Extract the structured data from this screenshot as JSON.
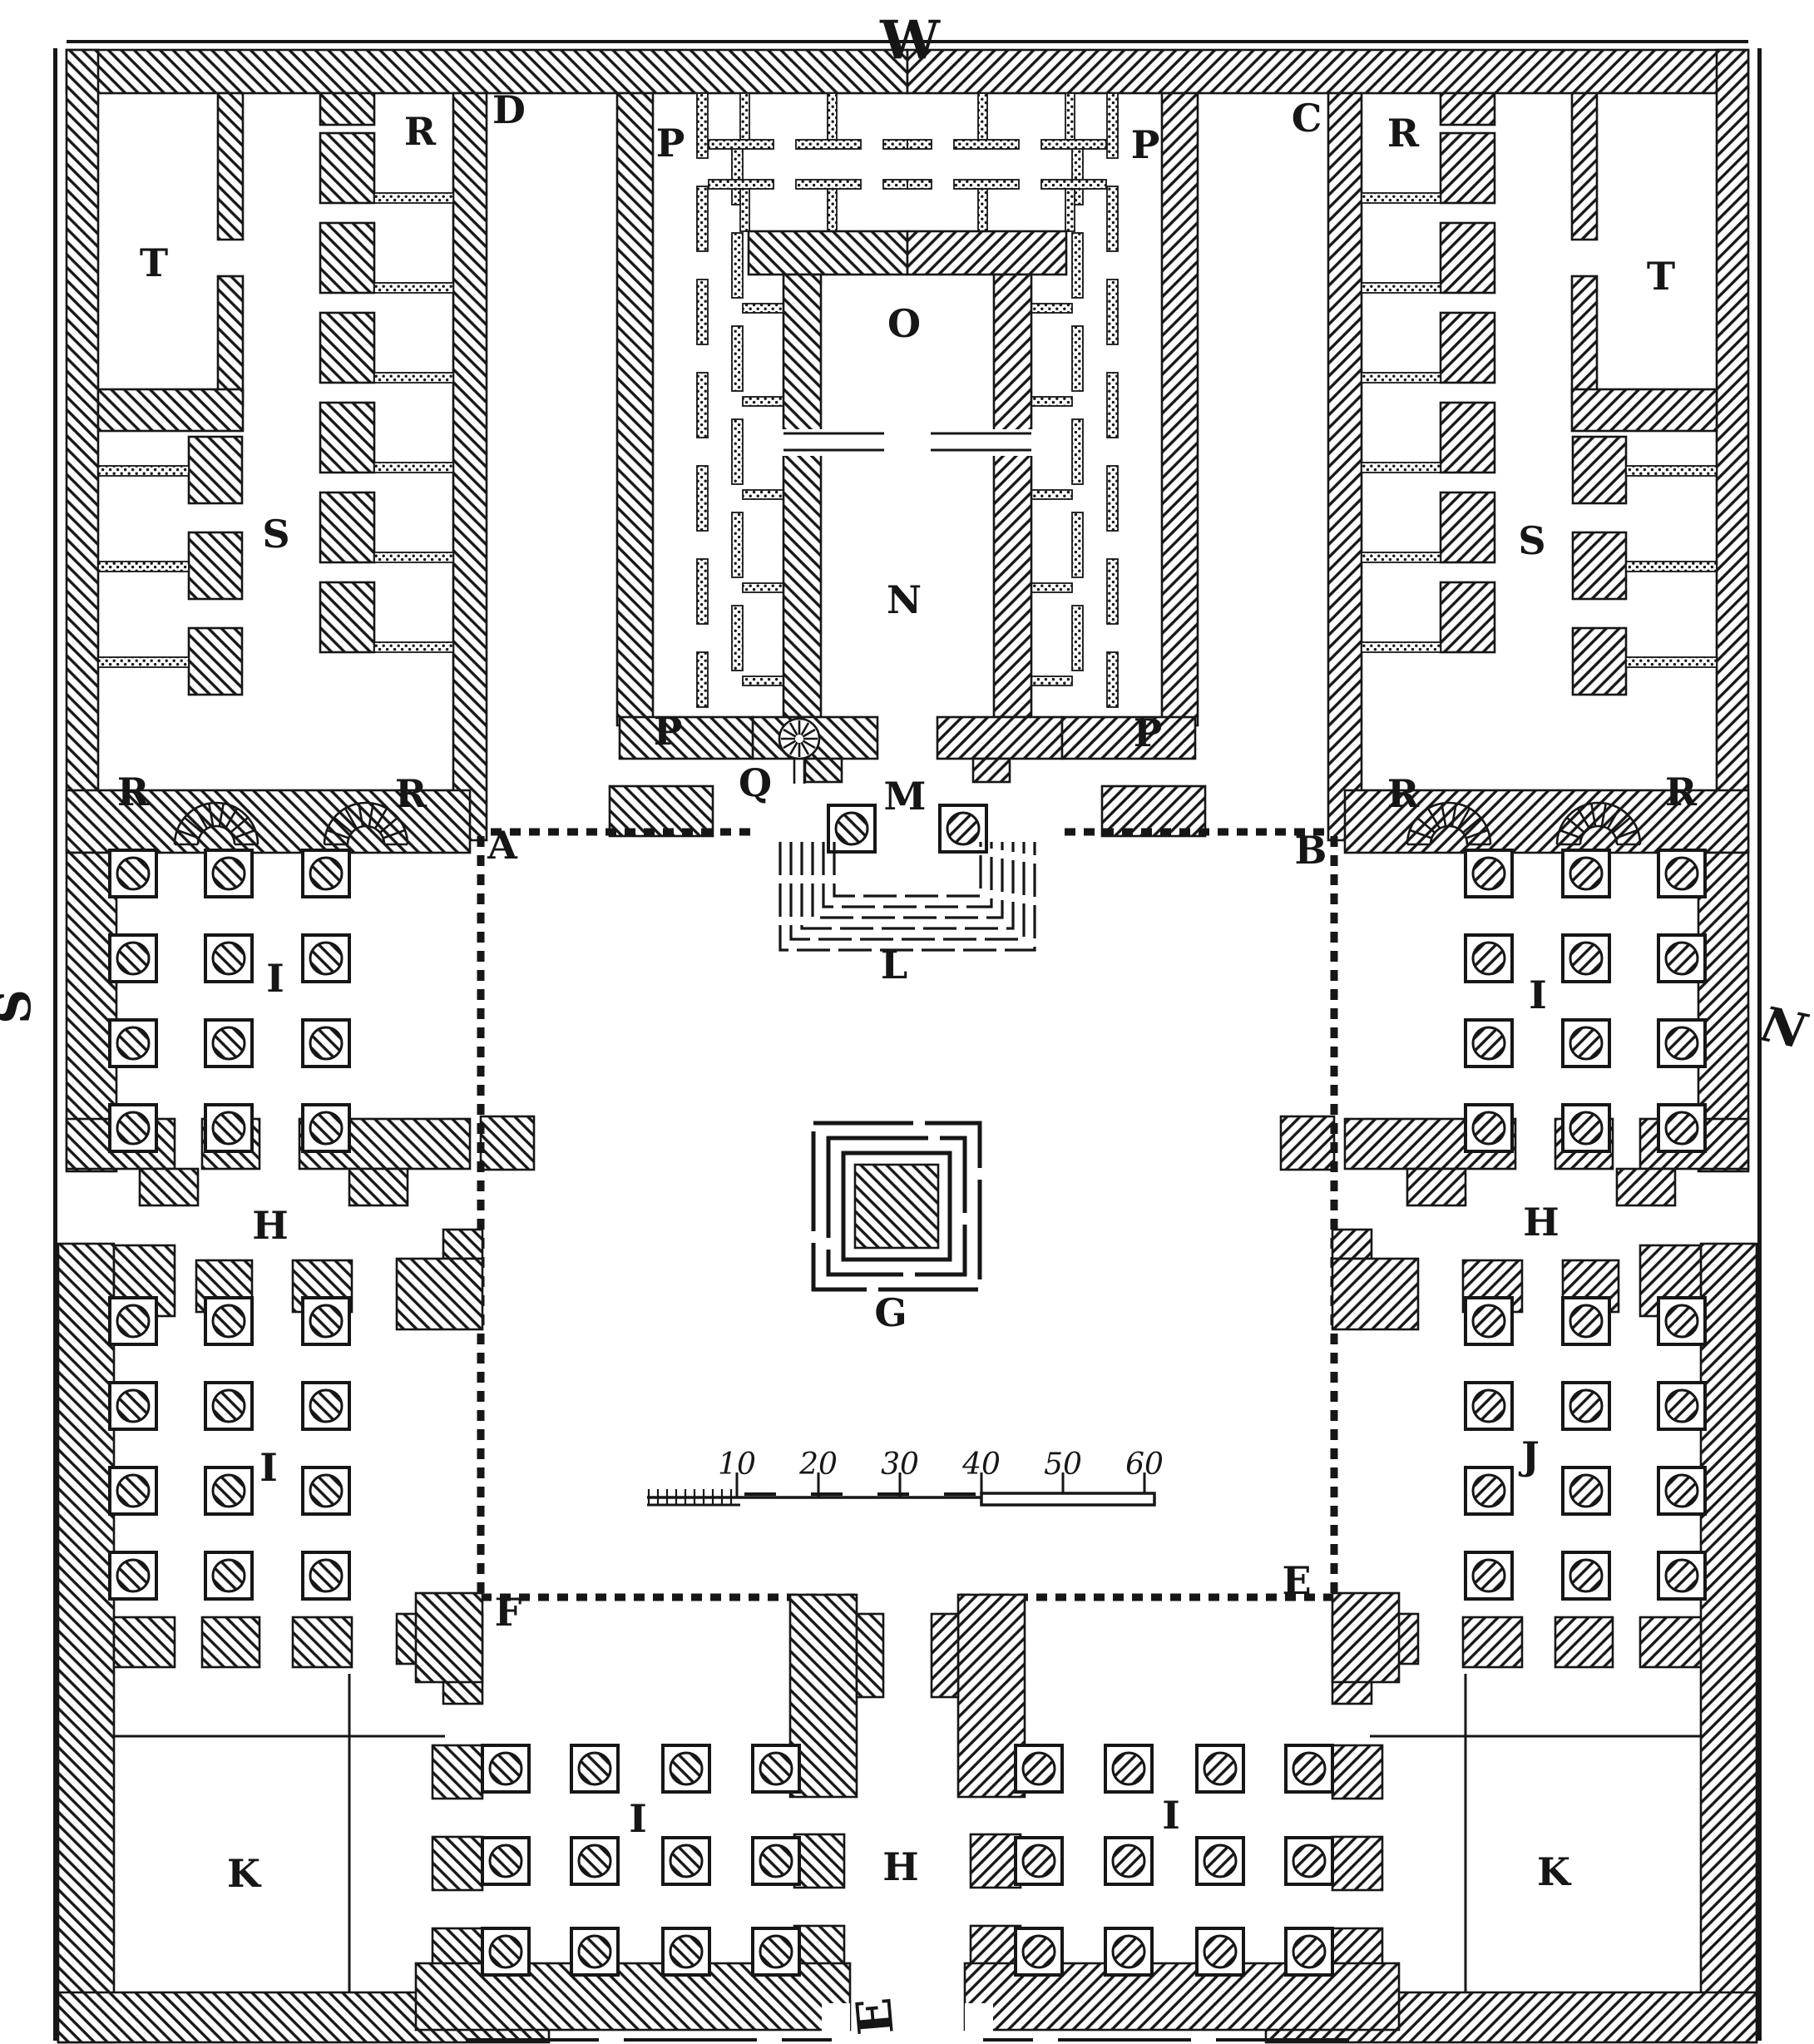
{
  "figure": {
    "kind": "engraved architectural floor plan",
    "theme": {
      "ink": "#161616",
      "paper": "#ffffff"
    }
  },
  "compass": {
    "west": "W",
    "south": "S",
    "north": "N",
    "east": "E"
  },
  "letters": {
    "A": "A",
    "B": "B",
    "C": "C",
    "D": "D",
    "E": "E",
    "F": "F",
    "G": "G",
    "H": "H",
    "I": "I",
    "J": "J",
    "K": "K",
    "L": "L",
    "M": "M",
    "N": "N",
    "O": "O",
    "P": "P",
    "Q": "Q",
    "R": "R",
    "S": "S",
    "T": "T",
    "W": "W"
  },
  "scalebar": {
    "ticks": [
      "10",
      "20",
      "30",
      "40",
      "50",
      "60"
    ]
  }
}
